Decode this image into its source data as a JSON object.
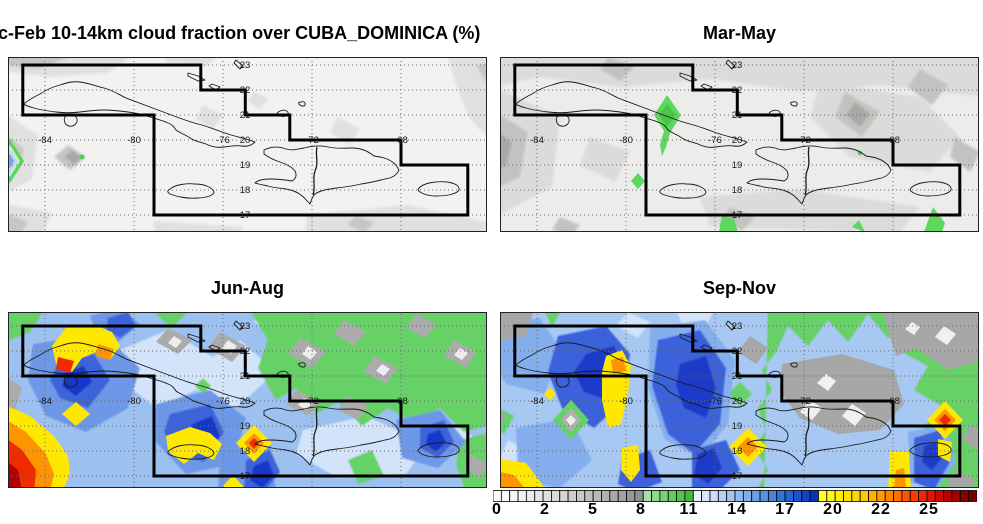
{
  "figure": {
    "background": "#ffffff",
    "panel_titles": {
      "dec_feb": "c-Feb 10-14km cloud fraction over CUBA_DOMINICA (%)",
      "mar_may": "Mar-May",
      "jun_aug": "Jun-Aug",
      "sep_nov": "Sep-Nov"
    }
  },
  "chart_data": {
    "type": "heatmap",
    "variable": "10-14km cloud fraction",
    "units": "%",
    "region_name": "CUBA_DOMINICA",
    "layout": "2x2 seasonal map panels over the Caribbean sharing one discrete horizontal colorbar below the Sep-Nov panel",
    "panels": [
      {
        "season": "Dec-Feb",
        "title_as_shown": "c-Feb 10-14km cloud fraction over CUBA_DOMINICA (%)",
        "field_summary": "mostly 0-8% (white-gray field); one ~8-14% green/blue diamond at the west edge near 20N and a small green speck near 81.5W/19.8N",
        "approx_range_pct": [
          0,
          14
        ]
      },
      {
        "season": "Mar-May",
        "title_as_shown": "Mar-May",
        "field_summary": "0-8% gray field with scattered 8-11% green patches over central Cuba, south of 17N and near the SE corner",
        "approx_range_pct": [
          0,
          11
        ]
      },
      {
        "season": "Jun-Aug",
        "title_as_shown": "Jun-Aug",
        "field_summary": "widespread 11-17% blues west of 72W; 19-27% maxima over far-west Cuba, the SW corner, near Jamaica and at 18.5N/74.5W; 5-11% gray-green field east of 72W",
        "approx_range_pct": [
          2,
          27
        ]
      },
      {
        "season": "Sep-Nov",
        "title_as_shown": "Sep-Nov",
        "field_summary": "11-17% blues west of 72W with 19-26% maxima near 80W, at 18.5N/74.5W and 19.3N/65W; 5-11% green-gray over eastern Hispaniola and the NE",
        "approx_range_pct": [
          2,
          26
        ]
      }
    ],
    "map": {
      "lon_ticks": [
        -84,
        -80,
        -76,
        -72,
        -68
      ],
      "lat_ticks": [
        23,
        22,
        21,
        20,
        19,
        18,
        17
      ],
      "lon_label_row_lat": 20,
      "grid_style": "dotted",
      "region_outline_lonlat": [
        [
          -85,
          23
        ],
        [
          -77,
          23
        ],
        [
          -77,
          22
        ],
        [
          -75,
          22
        ],
        [
          -75,
          21
        ],
        [
          -73,
          21
        ],
        [
          -73,
          20
        ],
        [
          -68,
          20
        ],
        [
          -68,
          19
        ],
        [
          -65,
          19
        ],
        [
          -65,
          17
        ],
        [
          -79.1,
          17
        ],
        [
          -79.1,
          21
        ],
        [
          -85,
          21
        ]
      ],
      "coastlines_shown": [
        "Cuba",
        "Isle of Youth",
        "Bahamas cays",
        "Jamaica",
        "Hispaniola with Haiti-DR border",
        "Puerto Rico"
      ]
    },
    "colorbar": {
      "orientation": "horizontal",
      "position": "bottom-right, below Sep-Nov panel",
      "tick_labels": [
        "0",
        "2",
        "5",
        "8",
        "11",
        "14",
        "17",
        "20",
        "22",
        "25"
      ],
      "segment_colors": [
        "#ffffff",
        "#fbfbfb",
        "#f6f6f6",
        "#f1f1f1",
        "#ebebeb",
        "#e6e6e6",
        "#e0e0e0",
        "#dadada",
        "#d4d4d4",
        "#cecece",
        "#c7c7c7",
        "#c0c0c0",
        "#b9b9b9",
        "#b1b1b1",
        "#a9a9a9",
        "#a1a1a1",
        "#999999",
        "#909090",
        "#a6e0a6",
        "#8fd98f",
        "#79d279",
        "#64cb64",
        "#51c351",
        "#41bb41",
        "#e9f1fb",
        "#d9e7f8",
        "#c8dcf6",
        "#b7d1f3",
        "#a5c6f0",
        "#93baed",
        "#80adea",
        "#6da0e6",
        "#5a92e2",
        "#4783de",
        "#3573d9",
        "#2463d4",
        "#1b53cc",
        "#1243c2",
        "#0a32b6",
        "#ffff2e",
        "#fff714",
        "#ffee00",
        "#ffe300",
        "#ffd700",
        "#ffca00",
        "#ffb300",
        "#ff9d00",
        "#ff8600",
        "#ff6e00",
        "#ff5500",
        "#ff3a00",
        "#f22600",
        "#e11500",
        "#cf0900",
        "#bb0000",
        "#a50000",
        "#8e0000",
        "#770000"
      ]
    }
  }
}
